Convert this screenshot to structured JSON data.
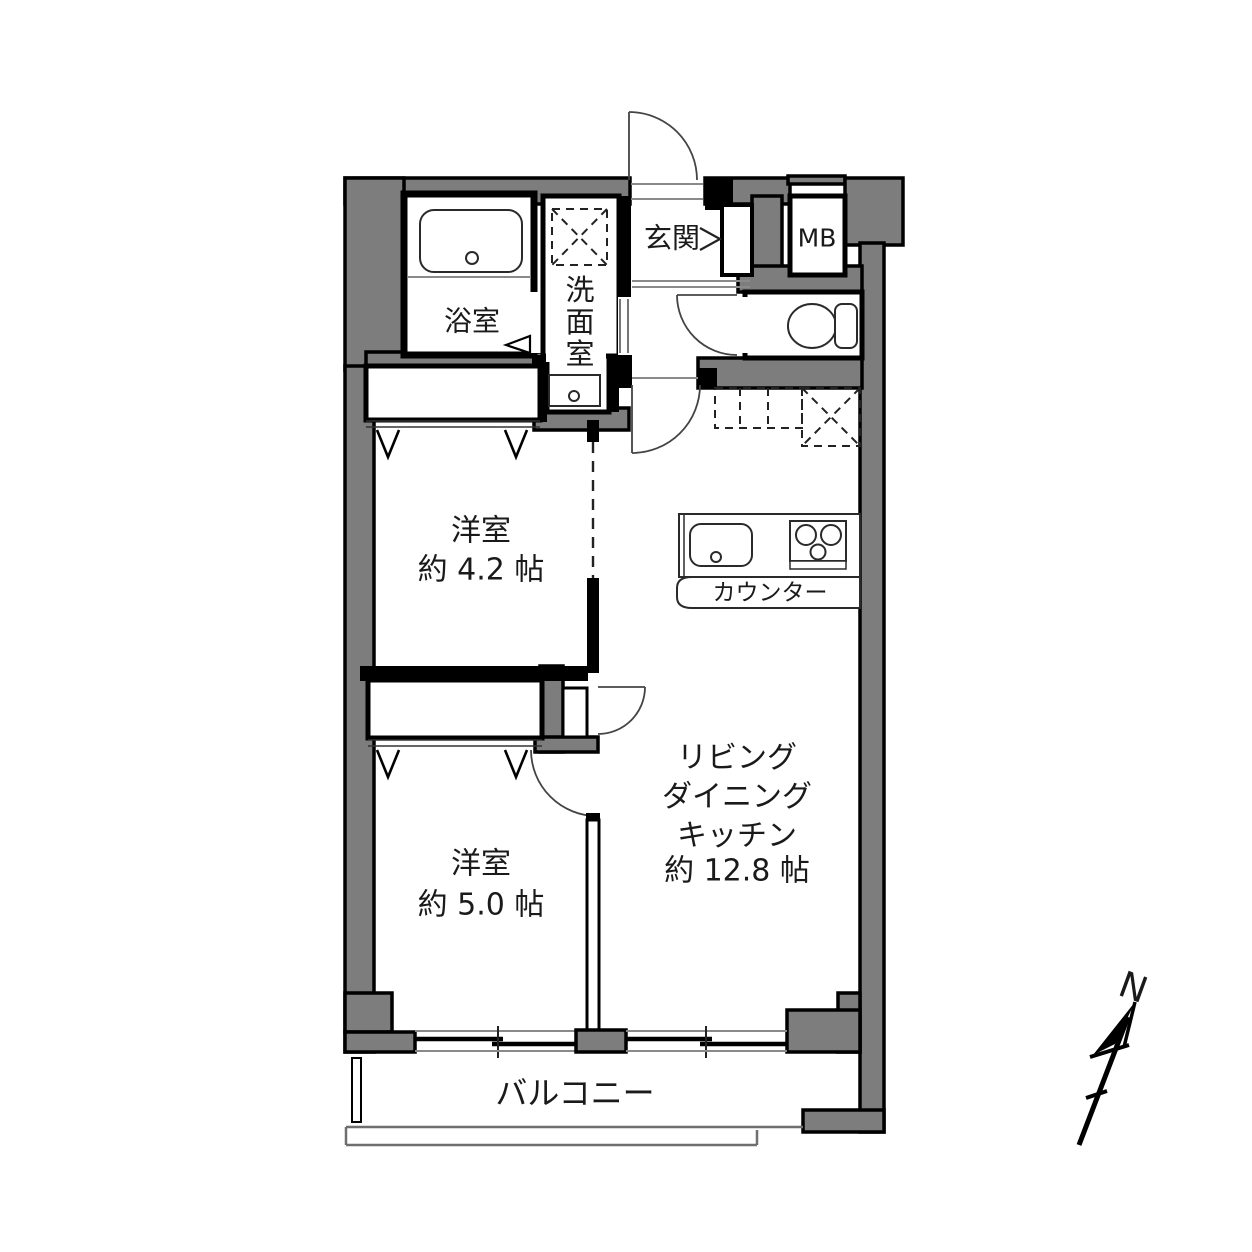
{
  "plan": {
    "type": "apartment-floor-plan",
    "colors": {
      "wall": "#7d7d7d",
      "line": "#000000",
      "background": "#ffffff"
    },
    "rooms": {
      "bathroom": {
        "label": "浴室"
      },
      "washroom": {
        "label": "洗面室",
        "chars": [
          "洗",
          "面",
          "室"
        ]
      },
      "entrance": {
        "label": "玄関"
      },
      "meter_box": {
        "label": "MB"
      },
      "bedroom1": {
        "label": "洋室",
        "size": "約 4.2 帖"
      },
      "bedroom2": {
        "label": "洋室",
        "size": "約 5.0 帖"
      },
      "ldk": {
        "lines": [
          "リビング",
          "ダイニング",
          "キッチン",
          "約 12.8 帖"
        ]
      },
      "counter": {
        "label": "カウンター"
      },
      "balcony": {
        "label": "バルコニー"
      }
    },
    "compass": {
      "label": "N"
    }
  }
}
